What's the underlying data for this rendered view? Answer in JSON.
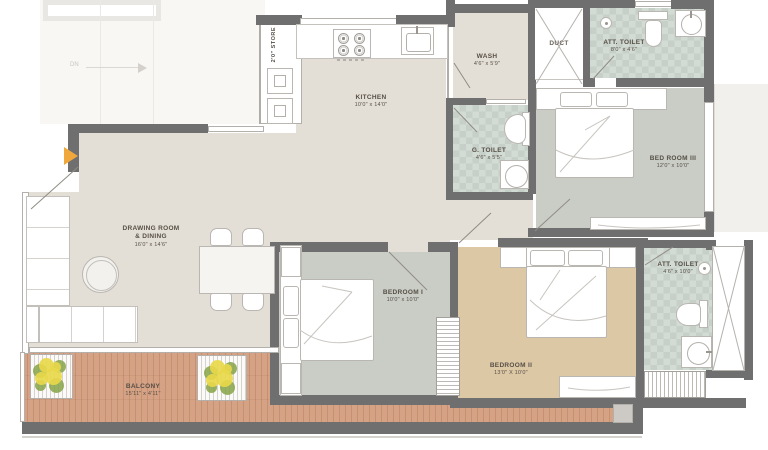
{
  "rooms": {
    "store": {
      "name": "2'0\" STORE"
    },
    "kitchen": {
      "name": "KITCHEN",
      "dim": "10'0\" x 14'0\""
    },
    "wash": {
      "name": "WASH",
      "dim": "4'6\" x 5'9\""
    },
    "duct": {
      "name": "DUCT"
    },
    "att_toilet_top": {
      "name": "ATT. TOILET",
      "dim": "8'0\" x 4'6\""
    },
    "bed_room_3": {
      "name": "BED ROOM III",
      "dim": "12'0\" x 10'0\""
    },
    "g_toilet": {
      "name": "G. TOILET",
      "dim": "4'6\" x 5'5\""
    },
    "drawing": {
      "name_line1": "DRAWING ROOM",
      "name_line2": "& DINING",
      "dim": "16'0\" x 14'6\""
    },
    "bedroom_1": {
      "name": "BEDROOM I",
      "dim": "10'0\" x 10'0\""
    },
    "bedroom_2": {
      "name": "BEDROOM II",
      "dim": "13'0\" X 10'0\""
    },
    "att_toilet_bottom": {
      "name": "ATT. TOILET",
      "dim": "4'6\" x 10'0\""
    },
    "balcony": {
      "name": "BALCONY",
      "dim": "15'11\" x 4'11\""
    }
  },
  "annotations": {
    "stair_direction": "DN"
  },
  "colors": {
    "wall": "#6f6f6f",
    "floor_main": "#e4dfd6",
    "floor_bed": "#c9cdc5",
    "floor_bed2": "#ddc8a6",
    "tile": "#c6cfc8",
    "tile_alt": "#d3dcd4",
    "wood": "#d6a285",
    "accent": "#f0a83c",
    "plant_green": "#86a246",
    "plant_yellow": "#e8d84b"
  }
}
